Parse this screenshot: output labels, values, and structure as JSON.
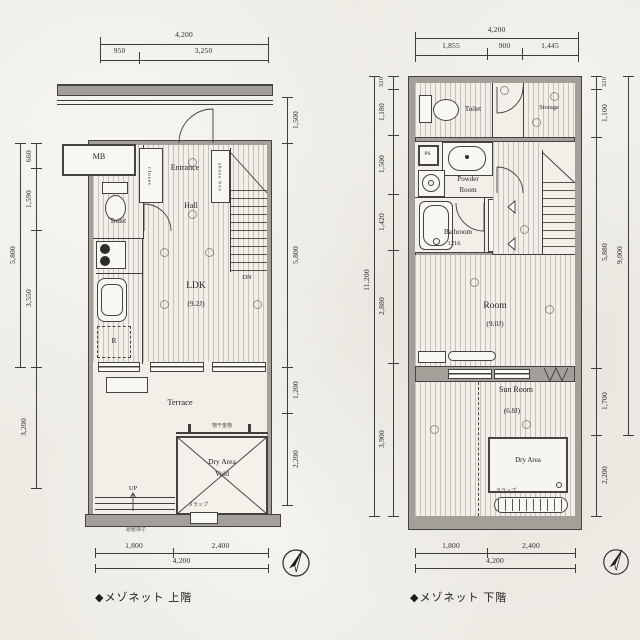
{
  "captions": {
    "upper": "◆メゾネット 上階",
    "lower": "◆メゾネット 下階"
  },
  "upper": {
    "dims": {
      "top_total": "4,200",
      "top_a": "950",
      "top_b": "3,250",
      "left_a": "660",
      "left_b": "1,590",
      "left_c": "3,550",
      "left_total": "5,800",
      "left_d": "3,200",
      "right_a": "1,500",
      "right_b": "5,800",
      "right_c": "1,200",
      "right_d": "2,200",
      "bottom_a": "1,800",
      "bottom_b": "2,400",
      "bottom_total": "4,200"
    },
    "labels": {
      "mb": "MB",
      "entrance": "Entrance",
      "closet": "closet",
      "shoes_box": "shoes box",
      "hall": "Hall",
      "toilet": "Toilet",
      "ldk": "LDK",
      "ldk_size": "(9.2J)",
      "dn": "DN",
      "fridge": "R",
      "terrace": "Terrace",
      "dry_area_1": "Dry Area",
      "dry_area_2": "Void",
      "up": "UP",
      "hanger": "物干金物",
      "ladder": "タラップ",
      "note": "避難梯子"
    }
  },
  "lower": {
    "dims": {
      "top_total": "4,200",
      "top_a": "1,855",
      "top_b": "900",
      "top_c": "1,445",
      "left_a": "320",
      "left_b": "1,180",
      "left_c": "1,500",
      "left_d": "1,420",
      "left_e": "2,880",
      "left_f": "3,900",
      "left_total": "11,200",
      "right_a": "320",
      "right_b": "1,100",
      "right_c": "5,880",
      "right_d": "1,700",
      "right_e": "2,200",
      "right_total": "9,000",
      "bottom_a": "1,800",
      "bottom_b": "2,400",
      "bottom_total": "4,200"
    },
    "labels": {
      "toilet": "Toilet",
      "storage": "Storage",
      "ps": "PS",
      "powder_1": "Powder",
      "powder_2": "Room",
      "hall": "Hall",
      "bathroom": "Bathroom",
      "bathroom_size": "1216",
      "closet": "closet",
      "up": "UP",
      "room": "Room",
      "room_size": "(9.0J)",
      "sun_room": "Sun Room",
      "sun_room_size": "(6.8J)",
      "dry_area": "Dry Area",
      "ladder": "タラップ"
    }
  }
}
